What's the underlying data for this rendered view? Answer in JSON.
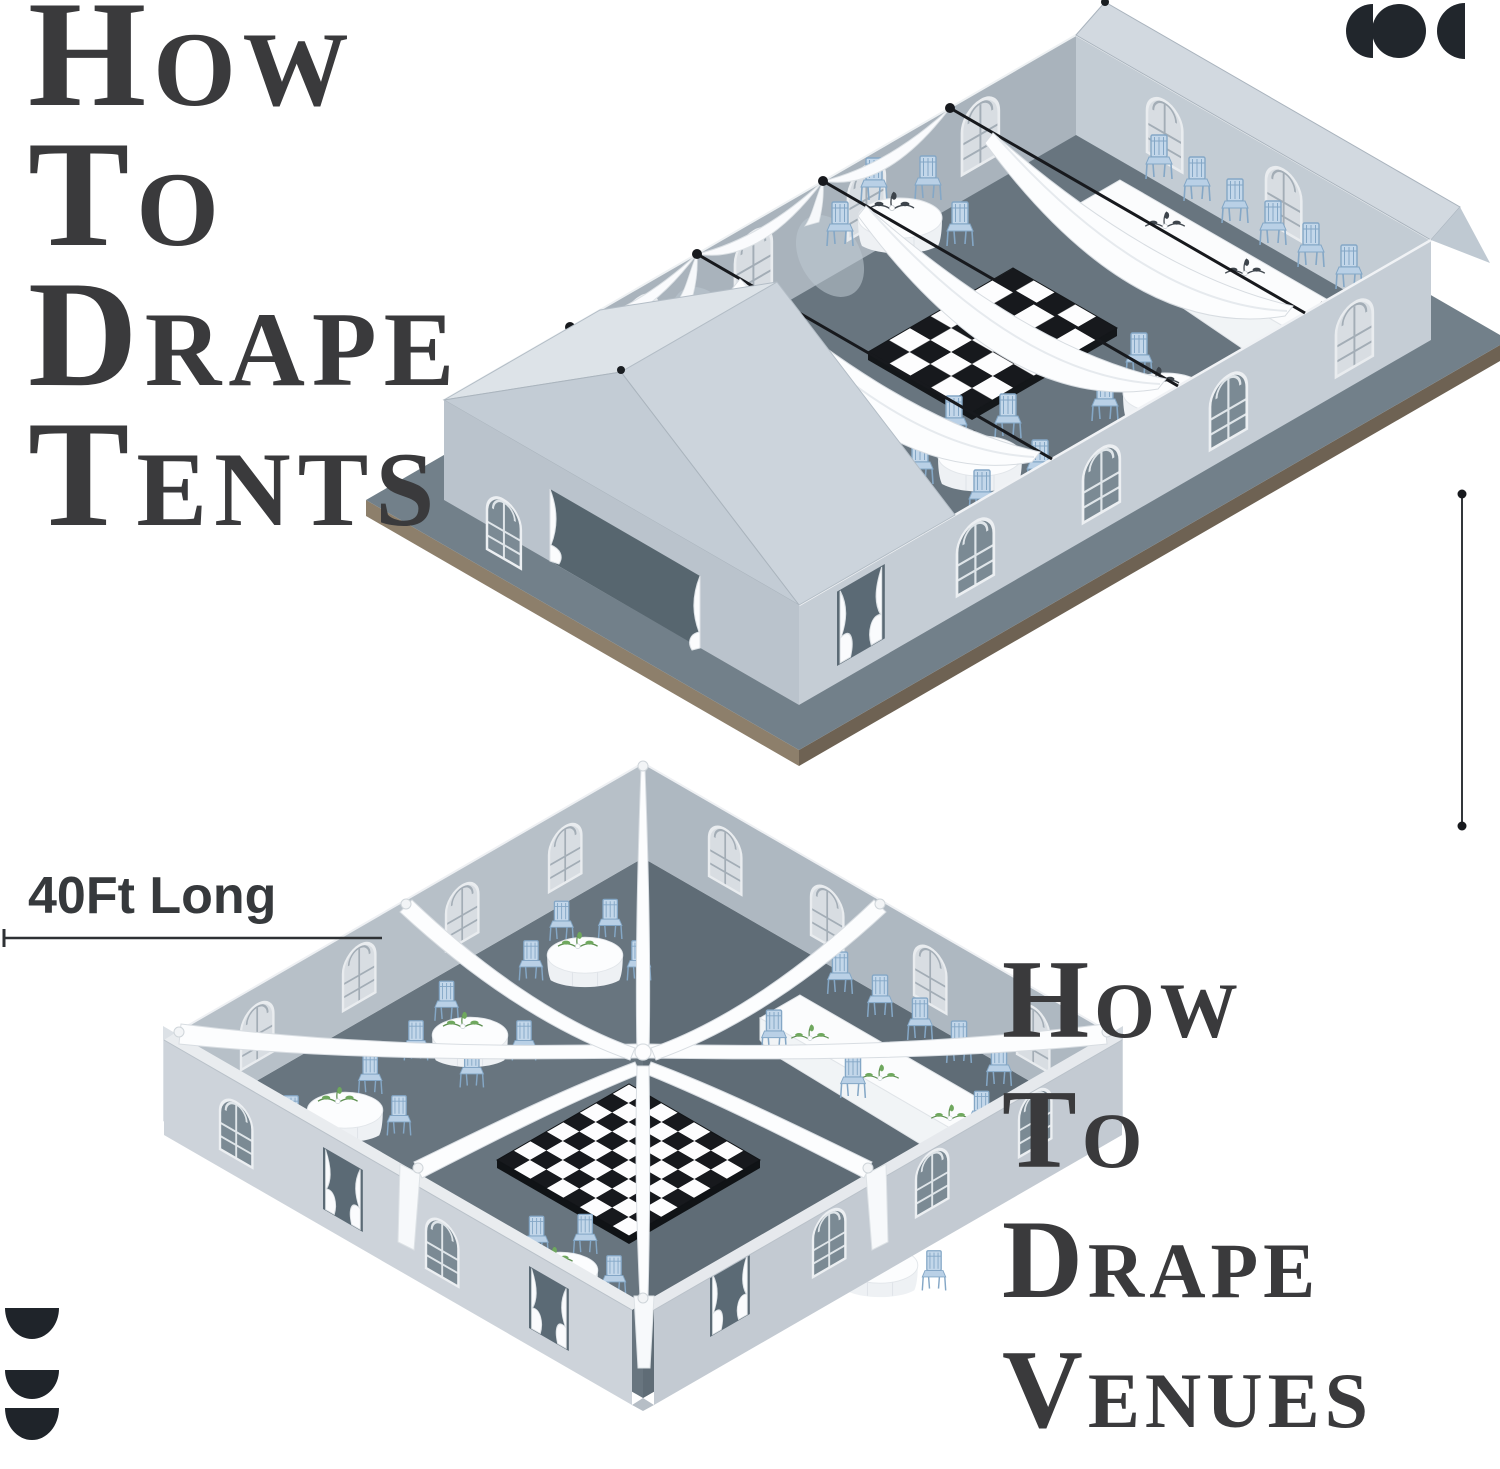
{
  "titles": {
    "top": {
      "lines": [
        "How",
        "To",
        "Drape",
        "Tents"
      ],
      "color": "#3a3a3c"
    },
    "bottom": {
      "lines": [
        "How",
        "To",
        "Drape",
        "Venues"
      ],
      "color": "#3a3a3c"
    }
  },
  "measurement": {
    "length_label": "40Ft Long"
  },
  "icons": {
    "logo": "three-dark-circles",
    "corner_marks": "three-stacked-half-discs"
  },
  "illustrations": {
    "tent": {
      "name": "draped-tent-isometric",
      "shows": "Isometric cutaway of a gabled frame tent: black ceiling beams with flowing white drapes, swag drapes along the back wall, a black-and-white checkered dance floor, round tables and a scalloped head table with light blue chiavari chairs, arched windows and tied entrance curtains, all on a gray deck with a tan edge"
    },
    "venue": {
      "name": "draped-venue-isometric",
      "shows": "Isometric cutaway of a square venue: eight white drapes radiating from a center knot, black-and-white checkered dance floor, round tables with greenery centerpieces, a long banquet table, light blue chiavari chairs, arched windows and tied curtains in wall openings"
    }
  },
  "colors": {
    "title_text": "#3a3a3c",
    "floor": "#68757f",
    "floor_shadow": "#5c6973",
    "wall_exterior": "#c5cdd5",
    "wall_interior": "#a9b3bc",
    "drape_white": "#fcfdfe",
    "chair_blue": "#b9d0e6",
    "checker_black": "#17191d",
    "checker_white": "#fdfdfe",
    "deck_edge_tan": "#8a7c66",
    "greenery_green": "#6fa85e",
    "icon_dark": "#21262c"
  }
}
